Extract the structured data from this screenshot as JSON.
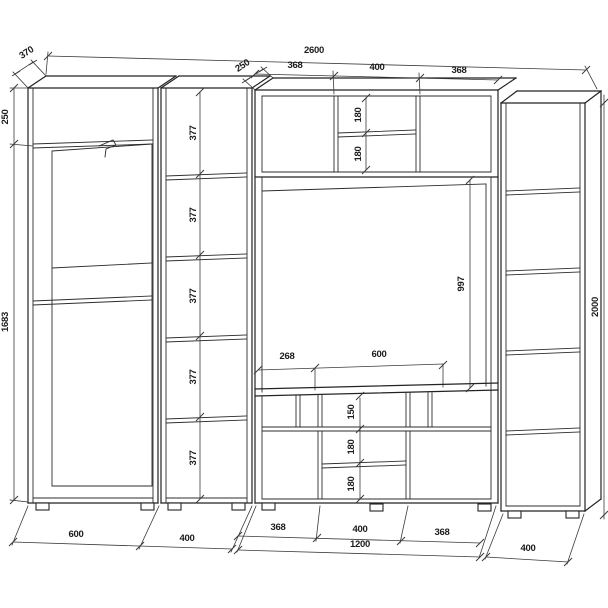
{
  "drawing": {
    "title": "Wall unit cabinet dimension drawing",
    "line_color": "#232323",
    "dim_color": "#3a3a3a",
    "background": "#ffffff"
  },
  "dims": {
    "overall_width": "2600",
    "overall_height": "2000",
    "wardrobe_depth": "370",
    "hutch_depth": "250",
    "wardrobe_top_compartment": "250",
    "wardrobe_side_height": "1683",
    "shelf_cells": [
      "377",
      "377",
      "377",
      "377",
      "377"
    ],
    "top_segments": {
      "left": "368",
      "center": "400",
      "right": "368"
    },
    "hutch": {
      "upper": "180",
      "lower": "180"
    },
    "niche": {
      "height": "997",
      "left": "268",
      "center": "600"
    },
    "bench": {
      "top_row": "150",
      "middle": "180",
      "bottom": "180"
    },
    "bottom_segments": {
      "left": "368",
      "center": "400",
      "right": "368",
      "total": "1200"
    },
    "bottom_widths": {
      "wardrobe": "600",
      "shelf_column": "400",
      "right_unit": "400"
    }
  }
}
